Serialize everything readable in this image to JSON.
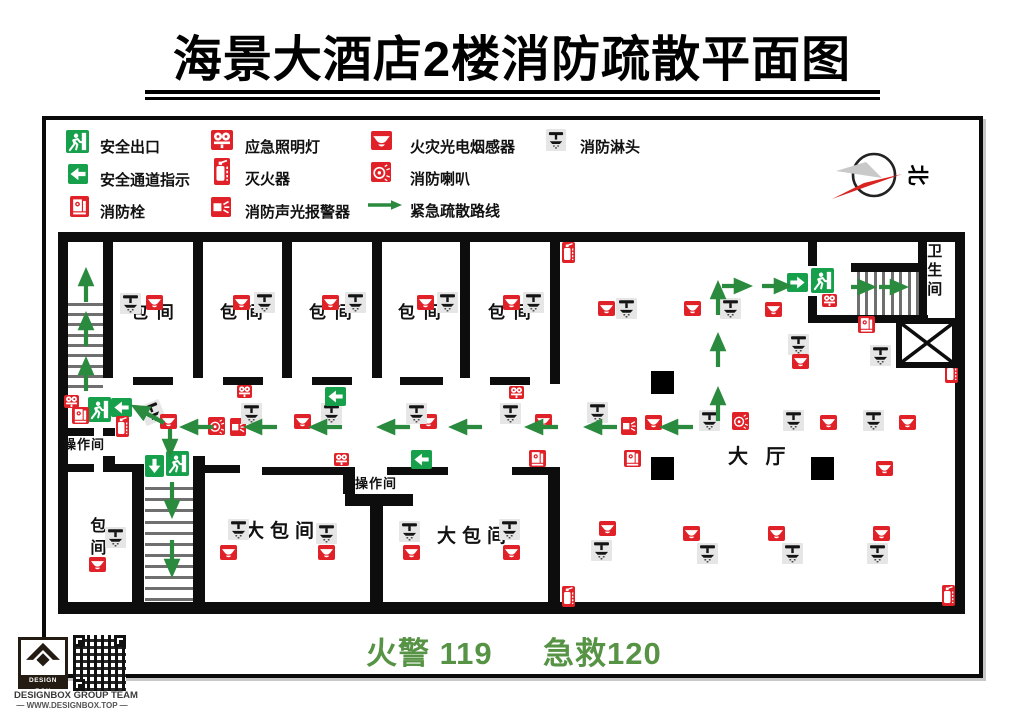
{
  "title": "海景大酒店2楼消防疏散平面图",
  "footer": {
    "fire": "火警 119",
    "ambulance": "急救120"
  },
  "compass": {
    "north_label": "北"
  },
  "branding": {
    "logo_text": "DESIGN BOX",
    "team": "DESIGNBOX GROUP TEAM",
    "site": "— WWW.DESIGNBOX.TOP —"
  },
  "colors": {
    "red": "#e02128",
    "sign_green": "#17a04b",
    "route_green": "#2a8a3e",
    "footer_green": "#579345",
    "wall": "#0d0d0d",
    "sprinkler_bg": "#e6e6e6"
  },
  "legend": {
    "items": [
      {
        "t": "runman",
        "label": "安全出口",
        "ix": 66,
        "iy": 130,
        "iw": 23,
        "ih": 23,
        "lx": 100,
        "ly": 136
      },
      {
        "t": "arrowleft",
        "label": "安全通道指示",
        "ix": 68,
        "iy": 164,
        "iw": 20,
        "ih": 20,
        "lx": 100,
        "ly": 169
      },
      {
        "t": "hydrant",
        "label": "消防栓",
        "ix": 70,
        "iy": 196,
        "iw": 19,
        "ih": 21,
        "lx": 100,
        "ly": 201
      },
      {
        "t": "emlight",
        "label": "应急照明灯",
        "ix": 211,
        "iy": 130,
        "iw": 22,
        "ih": 20,
        "lx": 245,
        "ly": 136
      },
      {
        "t": "ext",
        "label": "灭火器",
        "ix": 214,
        "iy": 158,
        "iw": 16,
        "ih": 27,
        "lx": 245,
        "ly": 168
      },
      {
        "t": "alarm",
        "label": "消防声光报警器",
        "ix": 211,
        "iy": 197,
        "iw": 20,
        "ih": 20,
        "lx": 245,
        "ly": 201
      },
      {
        "t": "smoke",
        "label": "火灾光电烟感器",
        "ix": 371,
        "iy": 131,
        "iw": 21,
        "ih": 19,
        "lx": 410,
        "ly": 136
      },
      {
        "t": "horn",
        "label": "消防喇叭",
        "ix": 371,
        "iy": 162,
        "iw": 20,
        "ih": 20,
        "lx": 410,
        "ly": 168
      },
      {
        "t": "routearrow",
        "label": "紧急疏散路线",
        "ix": 367,
        "iy": 199,
        "iw": 36,
        "ih": 12,
        "lx": 410,
        "ly": 200
      },
      {
        "t": "sprk",
        "label": "消防淋头",
        "ix": 546,
        "iy": 129,
        "iw": 20,
        "ih": 22,
        "lx": 580,
        "ly": 136
      }
    ]
  },
  "plan": {
    "walls": [
      [
        58,
        232,
        907,
        10
      ],
      [
        58,
        232,
        10,
        380
      ],
      [
        58,
        602,
        907,
        12
      ],
      [
        955,
        232,
        10,
        382
      ],
      [
        103,
        242,
        10,
        136
      ],
      [
        193,
        242,
        10,
        136
      ],
      [
        282,
        242,
        10,
        136
      ],
      [
        372,
        242,
        10,
        136
      ],
      [
        460,
        242,
        10,
        136
      ],
      [
        550,
        242,
        10,
        142
      ],
      [
        133,
        377,
        40,
        8
      ],
      [
        223,
        377,
        40,
        8
      ],
      [
        312,
        377,
        40,
        8
      ],
      [
        400,
        377,
        43,
        8
      ],
      [
        490,
        377,
        40,
        8
      ],
      [
        808,
        242,
        9,
        24
      ],
      [
        808,
        296,
        9,
        24
      ],
      [
        808,
        315,
        120,
        8
      ],
      [
        851,
        263,
        69,
        9
      ],
      [
        918,
        242,
        9,
        76
      ],
      [
        58,
        428,
        36,
        8
      ],
      [
        103,
        428,
        12,
        8
      ],
      [
        58,
        464,
        36,
        8
      ],
      [
        103,
        456,
        12,
        16
      ],
      [
        115,
        464,
        29,
        8
      ],
      [
        132,
        464,
        12,
        140
      ],
      [
        193,
        456,
        12,
        148
      ],
      [
        205,
        465,
        35,
        8
      ],
      [
        262,
        467,
        93,
        8
      ],
      [
        343,
        467,
        12,
        27
      ],
      [
        387,
        467,
        61,
        8
      ],
      [
        345,
        494,
        68,
        12
      ],
      [
        370,
        506,
        13,
        98
      ],
      [
        512,
        467,
        48,
        8
      ],
      [
        548,
        475,
        12,
        129
      ]
    ],
    "steps": [
      {
        "dir": "h",
        "x": 68,
        "w": 35,
        "ys": [
          303,
          313,
          323,
          334,
          344,
          354,
          365,
          375,
          385
        ]
      },
      {
        "dir": "h",
        "x": 145,
        "w": 48,
        "ys": [
          487,
          498,
          509,
          521,
          532,
          543,
          554,
          565,
          576,
          587,
          598
        ]
      },
      {
        "dir": "v",
        "y": 272,
        "h": 43,
        "xs": [
          857,
          865,
          874,
          882,
          891,
          899,
          908,
          916
        ]
      }
    ],
    "pillars": [
      [
        651,
        371,
        23
      ],
      [
        651,
        457,
        23
      ],
      [
        811,
        457,
        23
      ]
    ],
    "elevator": {
      "x": 896,
      "y": 318,
      "w": 62,
      "h": 50
    },
    "labels": [
      {
        "t": "包 间",
        "x": 131,
        "y": 303,
        "s": 17,
        "ls": 2
      },
      {
        "t": "包 间",
        "x": 220,
        "y": 303,
        "s": 17,
        "ls": 2
      },
      {
        "t": "包 间",
        "x": 309,
        "y": 303,
        "s": 17,
        "ls": 2
      },
      {
        "t": "包 间",
        "x": 398,
        "y": 303,
        "s": 17,
        "ls": 2
      },
      {
        "t": "包 间",
        "x": 488,
        "y": 303,
        "s": 17,
        "ls": 2
      },
      {
        "t": "大包间",
        "x": 245,
        "y": 521,
        "s": 19,
        "ls": 6
      },
      {
        "t": "大包间",
        "x": 437,
        "y": 526,
        "s": 19,
        "ls": 6
      },
      {
        "t": "操作间",
        "x": 63,
        "y": 438,
        "s": 13,
        "ls": 1
      },
      {
        "t": "操作间",
        "x": 355,
        "y": 477,
        "s": 13,
        "ls": 1
      },
      {
        "t": "大 厅",
        "x": 728,
        "y": 446,
        "s": 20,
        "ls": 6
      },
      {
        "t": "卫生间",
        "x": 925,
        "y": 243,
        "s": 15,
        "ls": 4,
        "v": true
      },
      {
        "t": "包间",
        "x": 86,
        "y": 517,
        "s": 16,
        "ls": 6,
        "v": true
      }
    ],
    "icons": [
      [
        "sprk",
        120,
        293
      ],
      [
        "smoke",
        146,
        295
      ],
      [
        "smoke",
        233,
        295
      ],
      [
        "sprk",
        254,
        292
      ],
      [
        "smoke",
        322,
        295
      ],
      [
        "sprk",
        345,
        292
      ],
      [
        "smoke",
        417,
        295
      ],
      [
        "sprk",
        437,
        292
      ],
      [
        "smoke",
        503,
        295
      ],
      [
        "sprk",
        523,
        292
      ],
      [
        "ext",
        562,
        242
      ],
      [
        "smoke",
        598,
        301
      ],
      [
        "sprk",
        616,
        298
      ],
      [
        "smoke",
        684,
        301
      ],
      [
        "sprk",
        720,
        298
      ],
      [
        "smoke",
        765,
        302
      ],
      [
        "sprk",
        788,
        334
      ],
      [
        "smoke",
        792,
        354
      ],
      [
        "sprk",
        870,
        345
      ],
      [
        "emlight",
        822,
        294
      ],
      [
        "hydrant",
        858,
        316
      ],
      [
        "ext",
        945,
        362
      ],
      [
        "smoke",
        876,
        461
      ],
      [
        "emlight",
        64,
        395
      ],
      [
        "runman",
        88,
        397
      ],
      [
        "arrowleft",
        111,
        398
      ],
      [
        "hydrant",
        72,
        407
      ],
      [
        "ext",
        116,
        416
      ],
      [
        "sprk",
        142,
        402,
        -22
      ],
      [
        "smoke",
        160,
        414
      ],
      [
        "horn",
        208,
        417
      ],
      [
        "alarm",
        230,
        418
      ],
      [
        "sprk",
        241,
        403
      ],
      [
        "smoke",
        294,
        414
      ],
      [
        "sprk",
        321,
        403
      ],
      [
        "smoke",
        420,
        414
      ],
      [
        "sprk",
        406,
        403
      ],
      [
        "sprk",
        500,
        403
      ],
      [
        "smoke",
        535,
        414
      ],
      [
        "sprk",
        587,
        402
      ],
      [
        "alarm",
        621,
        417
      ],
      [
        "smoke",
        645,
        415
      ],
      [
        "sprk",
        699,
        410
      ],
      [
        "horn",
        732,
        412
      ],
      [
        "sprk",
        783,
        410
      ],
      [
        "smoke",
        820,
        415
      ],
      [
        "sprk",
        863,
        410
      ],
      [
        "smoke",
        899,
        415
      ],
      [
        "emlight",
        237,
        385
      ],
      [
        "arrowleft",
        325,
        387
      ],
      [
        "emlight",
        509,
        386
      ],
      [
        "arrowright",
        787,
        273
      ],
      [
        "runman",
        811,
        268
      ],
      [
        "arrowdown",
        145,
        455
      ],
      [
        "runman",
        166,
        451
      ],
      [
        "emlight",
        334,
        453
      ],
      [
        "arrowleft",
        411,
        450
      ],
      [
        "hydrant",
        529,
        450
      ],
      [
        "hydrant",
        624,
        450
      ],
      [
        "sprk",
        105,
        527
      ],
      [
        "smoke",
        89,
        557
      ],
      [
        "sprk",
        228,
        519
      ],
      [
        "smoke",
        220,
        545
      ],
      [
        "sprk",
        316,
        523
      ],
      [
        "smoke",
        318,
        545
      ],
      [
        "sprk",
        399,
        521
      ],
      [
        "smoke",
        403,
        545
      ],
      [
        "sprk",
        499,
        519
      ],
      [
        "smoke",
        503,
        545
      ],
      [
        "smoke",
        599,
        521
      ],
      [
        "sprk",
        591,
        540
      ],
      [
        "smoke",
        683,
        526
      ],
      [
        "sprk",
        697,
        543
      ],
      [
        "smoke",
        768,
        526
      ],
      [
        "sprk",
        782,
        543
      ],
      [
        "smoke",
        873,
        526
      ],
      [
        "sprk",
        867,
        543
      ],
      [
        "ext",
        562,
        586
      ],
      [
        "ext",
        942,
        585
      ]
    ],
    "arrows": [
      [
        86,
        302,
        86,
        272
      ],
      [
        86,
        346,
        86,
        316
      ],
      [
        86,
        391,
        86,
        361
      ],
      [
        213,
        427,
        184,
        427
      ],
      [
        277,
        427,
        248,
        427
      ],
      [
        342,
        427,
        313,
        427
      ],
      [
        410,
        427,
        381,
        427
      ],
      [
        482,
        427,
        453,
        427
      ],
      [
        558,
        427,
        529,
        427
      ],
      [
        617,
        427,
        588,
        427
      ],
      [
        693,
        427,
        664,
        427
      ],
      [
        164,
        423,
        135,
        407
      ],
      [
        170,
        429,
        170,
        453
      ],
      [
        172,
        482,
        172,
        514
      ],
      [
        172,
        540,
        172,
        573
      ],
      [
        718,
        421,
        718,
        391
      ],
      [
        718,
        367,
        718,
        337
      ],
      [
        718,
        315,
        718,
        285
      ],
      [
        722,
        286,
        748,
        286
      ],
      [
        762,
        286,
        788,
        286
      ],
      [
        851,
        287,
        872,
        287
      ],
      [
        879,
        287,
        904,
        287
      ]
    ]
  }
}
